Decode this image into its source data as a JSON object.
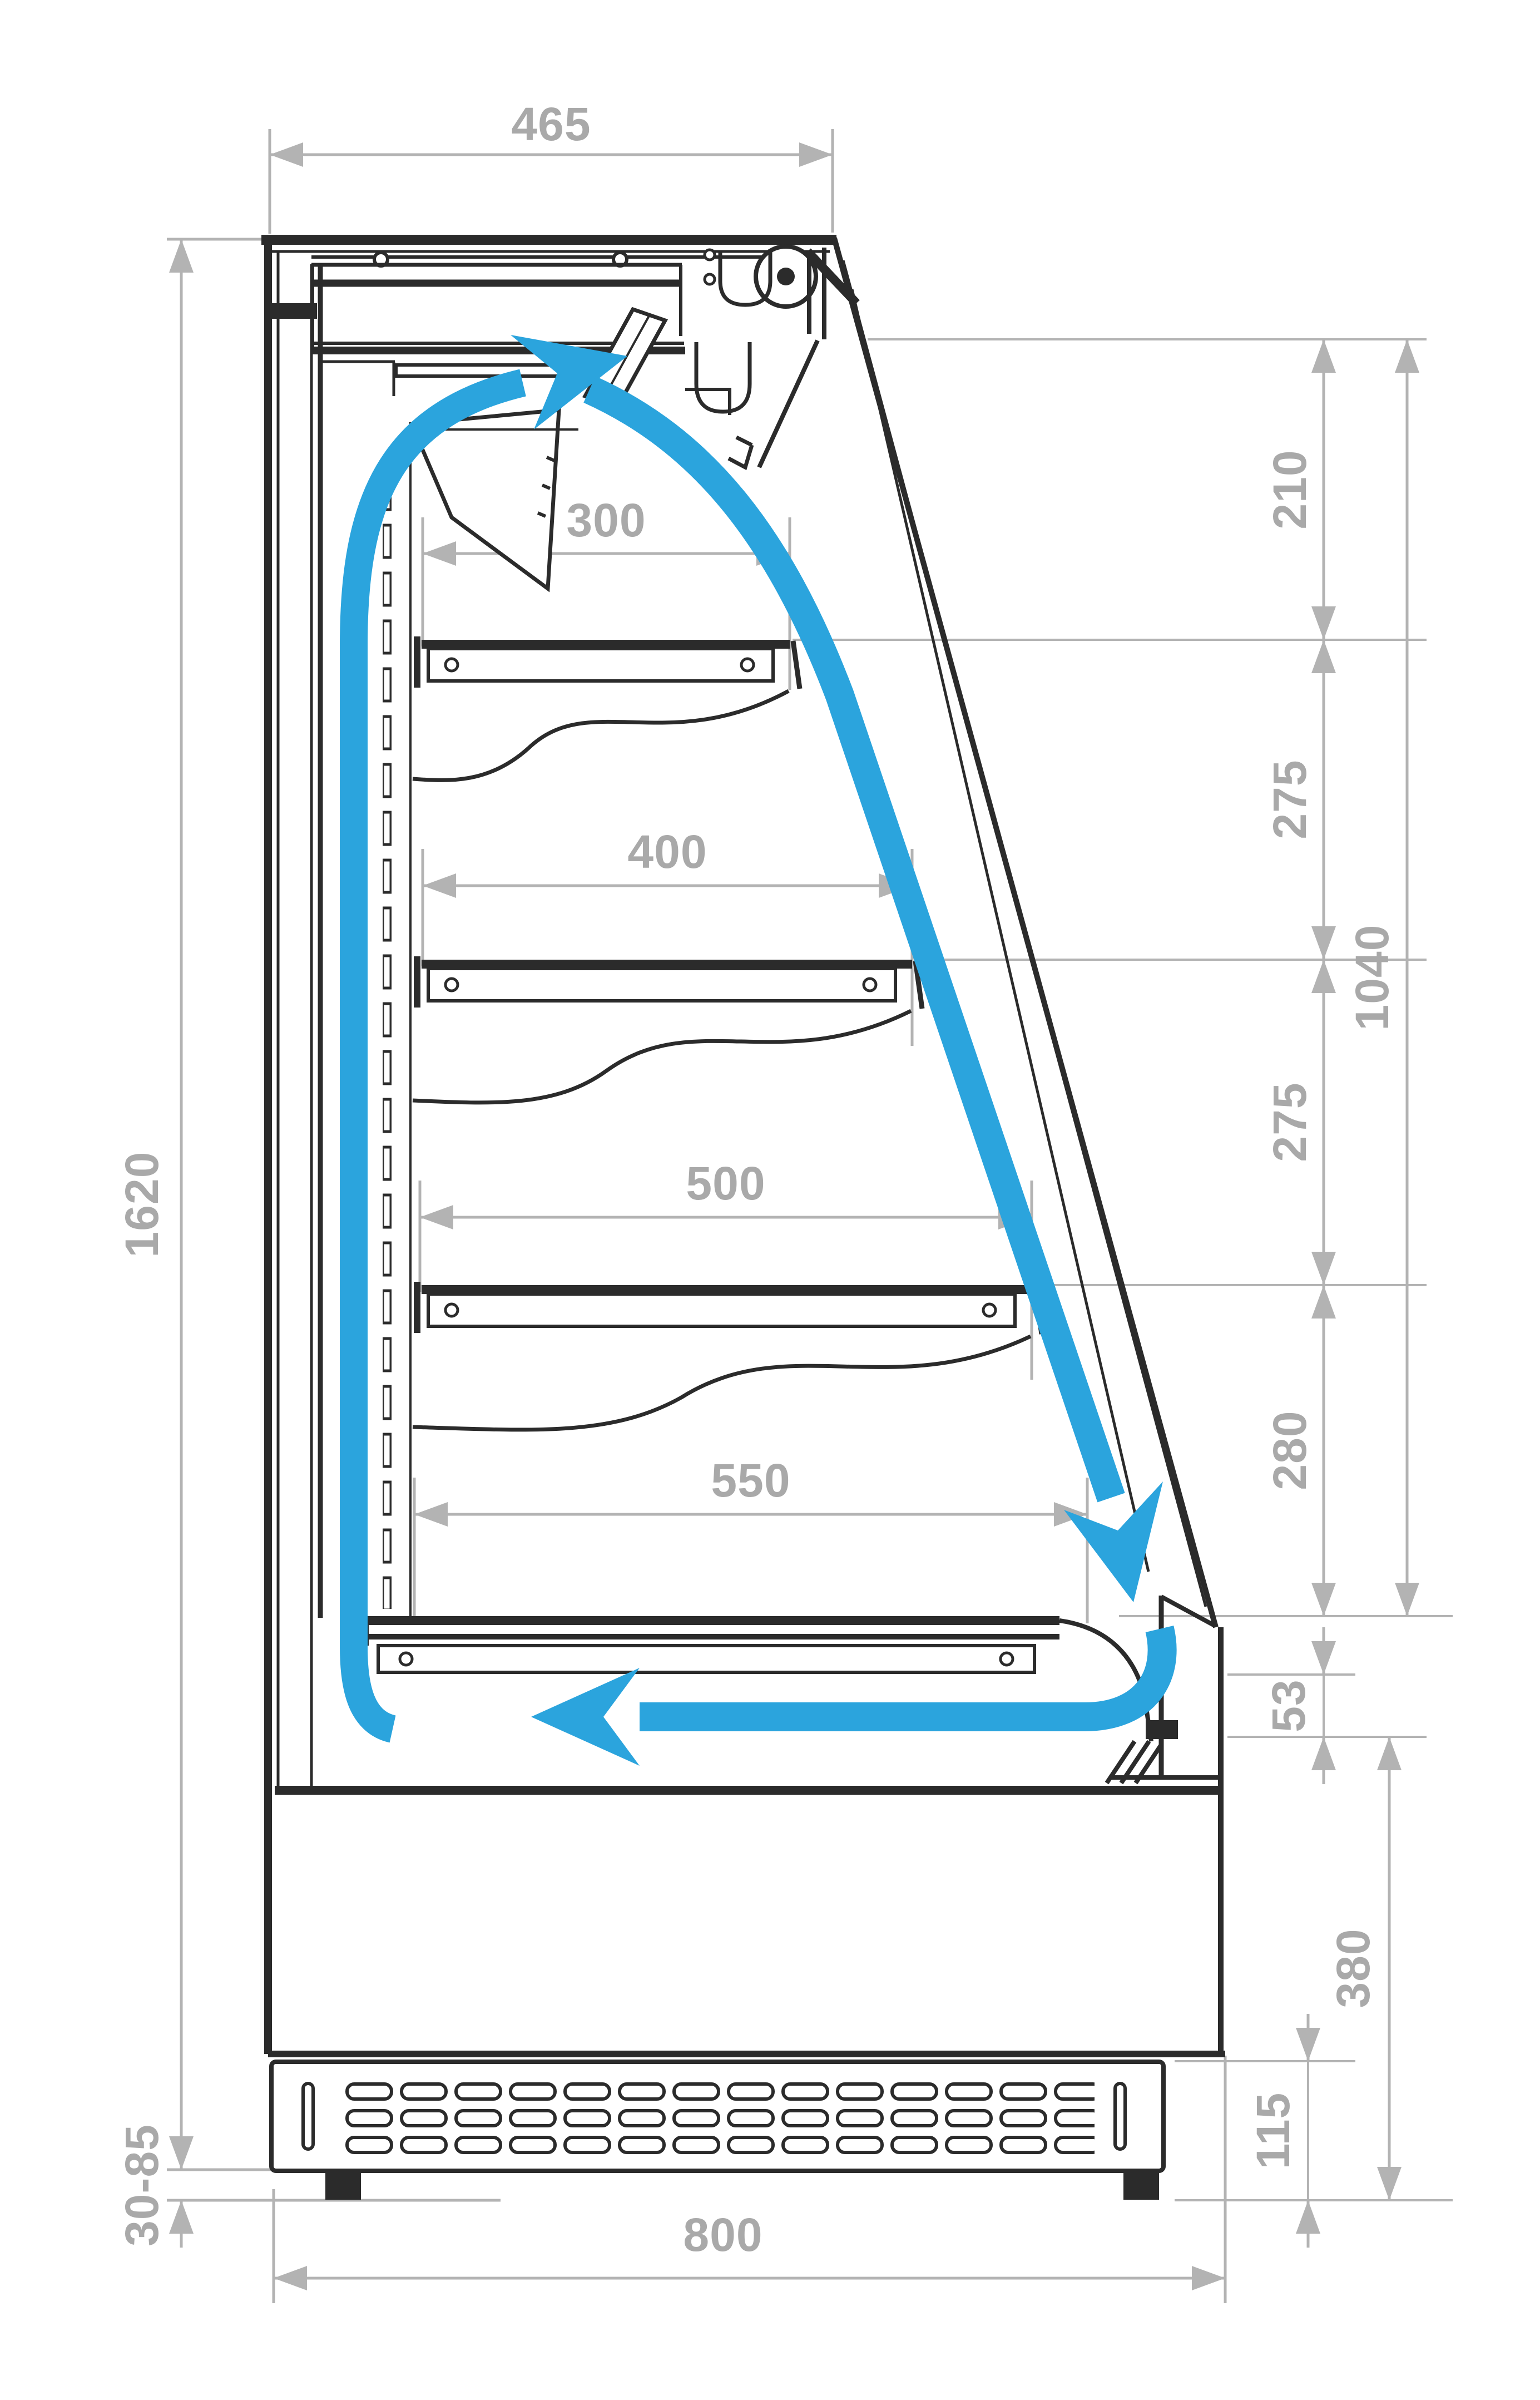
{
  "diagram": {
    "kind": "technical-cross-section",
    "subject": "open-front refrigerated display cabinet, side section with air circulation",
    "colors": {
      "outline": "#2b2b2b",
      "dim_line": "#b3b3b3",
      "dim_text": "#a9a9a9",
      "airflow": "#2ba4dd",
      "background": "#ffffff"
    },
    "dims": {
      "top_width": "465",
      "overall_height": "1620",
      "feet_adjust": "30-85",
      "base_width": "800",
      "shelf_1_depth": "300",
      "shelf_2_depth": "400",
      "shelf_3_depth": "500",
      "deck_depth": "550",
      "level_top": "210",
      "level_mid_1": "275",
      "level_mid_2": "275",
      "level_bottom": "280",
      "opening_total": "1040",
      "front_step": "53",
      "base_height": "380",
      "plinth_height": "115"
    },
    "airflow_arrows": {
      "discharge": "top air discharge arrow",
      "curtain": "front air curtain arrow",
      "return": "bottom return air arrow"
    }
  }
}
